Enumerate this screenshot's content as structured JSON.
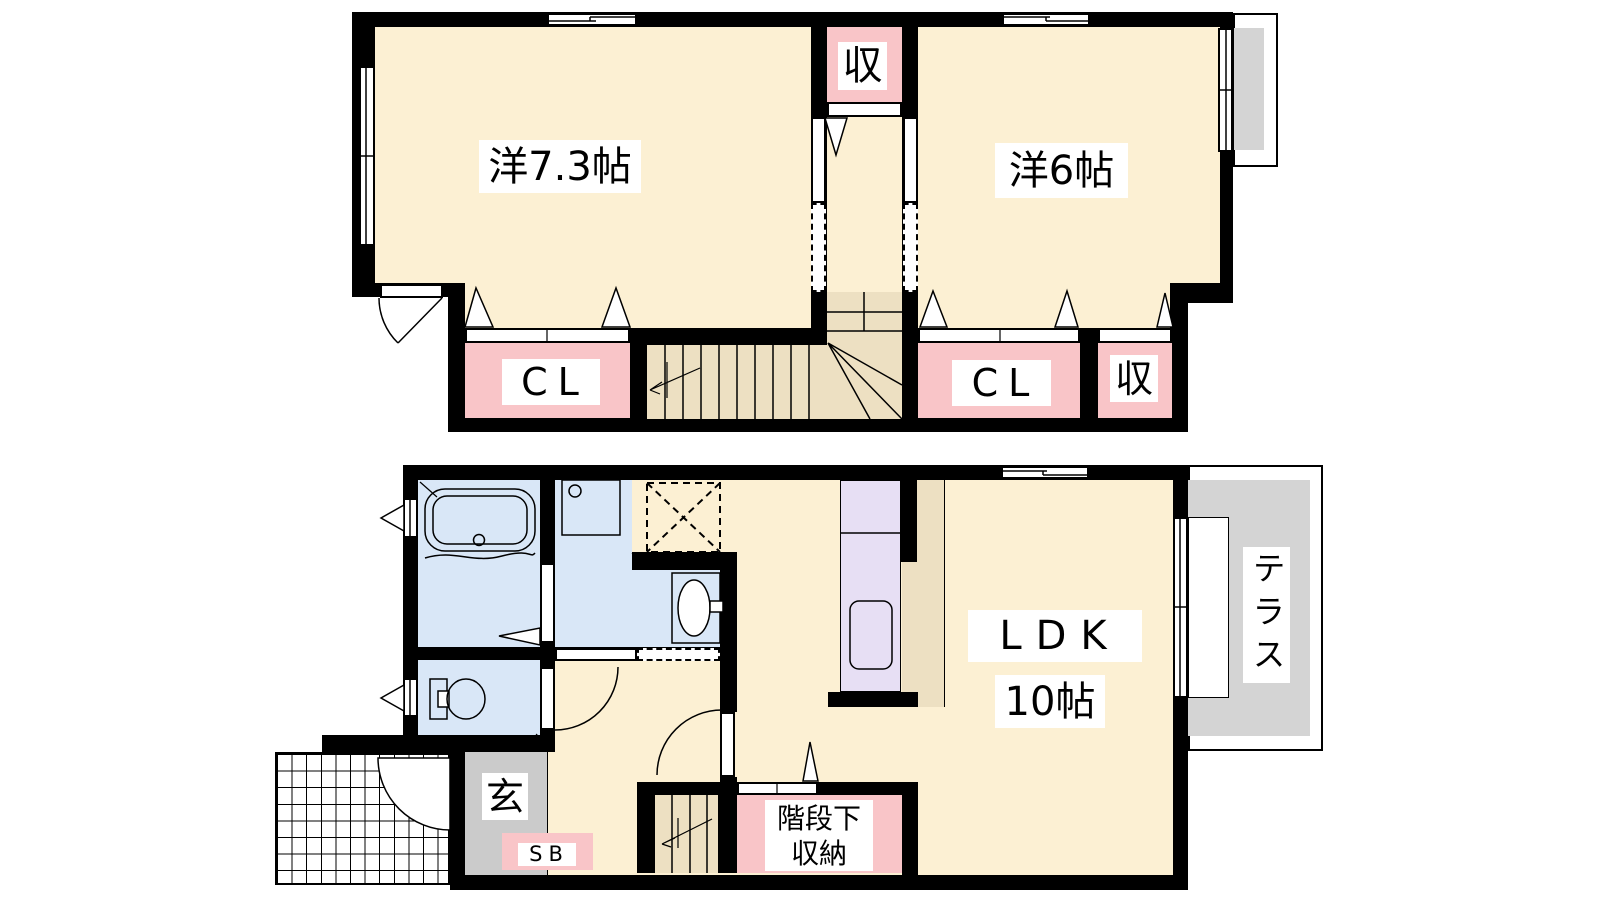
{
  "palette": {
    "wall": "#000000",
    "floor": "#FCF0D3",
    "closet": "#F9C5C8",
    "wet": "#D9E7F7",
    "kitchen": "#E7DFF4",
    "entrance_gray": "#CBCBCB",
    "terrace_gray": "#D4D4D4",
    "stairs": "#EDE0C2",
    "label_bg": "#FFFFFF"
  },
  "floor2": {
    "room_west_73": "洋7.3帖",
    "room_west_6": "洋6帖",
    "storage_top": "収",
    "closet_left": "CL",
    "closet_right": "CL",
    "storage_right": "収"
  },
  "floor1": {
    "ldk": "LDK",
    "ldk_size": "10帖",
    "terrace": "テラス",
    "entrance": "玄",
    "shoe_box": "SB",
    "under_stairs_line1": "階段下",
    "under_stairs_line2": "収納"
  }
}
